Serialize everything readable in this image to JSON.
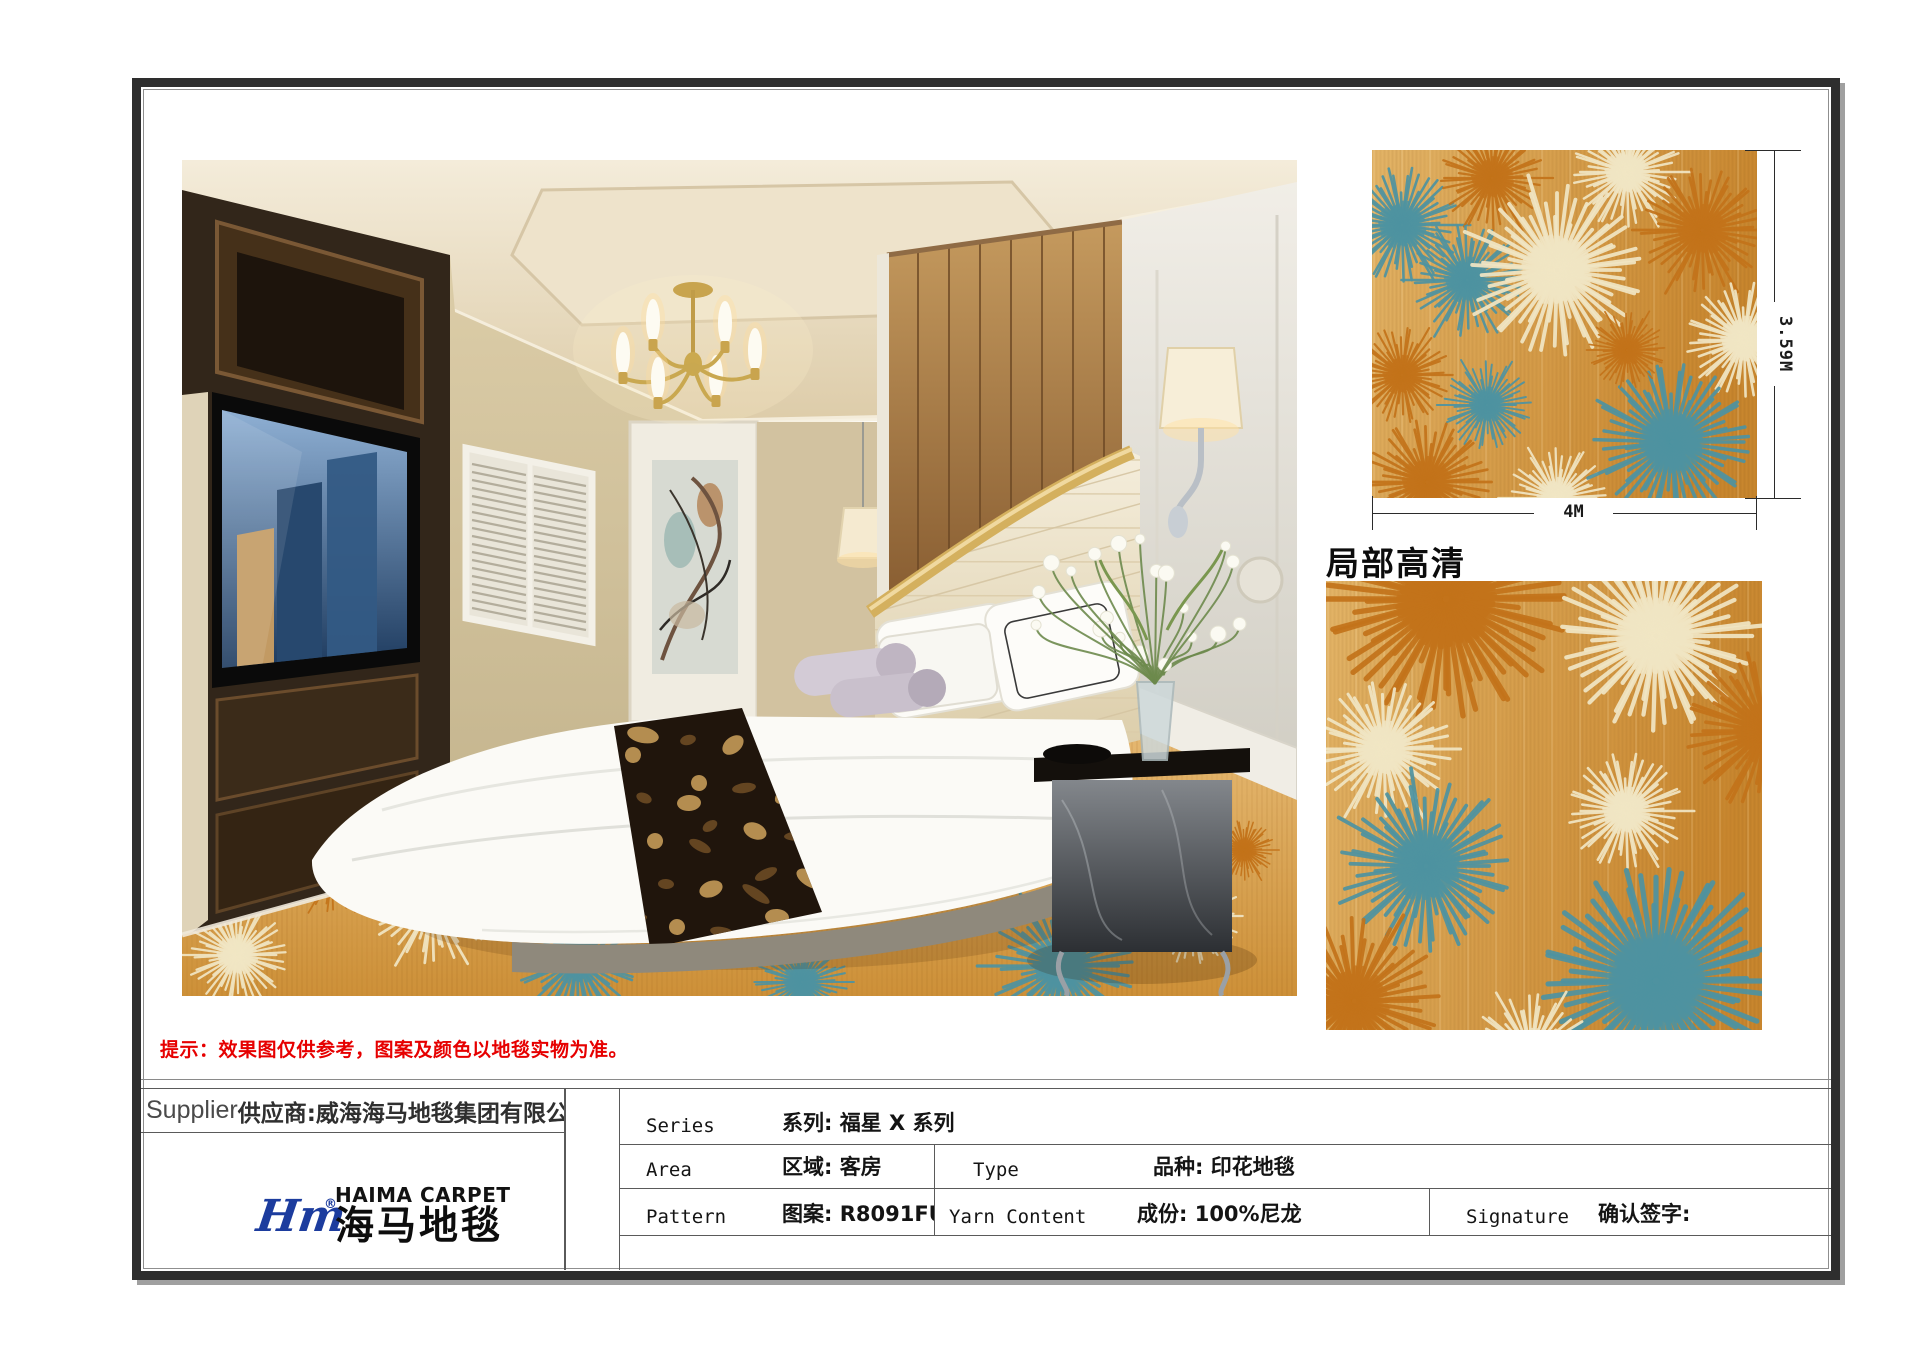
{
  "page": {
    "disclaimer": "提示：效果图仅供参考，图案及颜色以地毯实物为准。",
    "closeup_label": "局部高清"
  },
  "dimensions": {
    "width": "4M",
    "height": "3.59M"
  },
  "carpet_colors": {
    "base_light": "#E3B467",
    "base_dark": "#C8862E",
    "cream": "#F1E6C4",
    "orange": "#C3731A",
    "teal": "#4E93A1"
  },
  "logo": {
    "script": "Hm",
    "en": "HAIMA CARPET",
    "cn": "海马地毯",
    "registered": "®",
    "blue": "#1C3C9E"
  },
  "titleblock": {
    "supplier": {
      "en": "Supplier",
      "cn": "供应商:威海海马地毯集团有限公司"
    },
    "series": {
      "en": "Series",
      "cn": "系列: 福星 X 系列"
    },
    "area": {
      "en": "Area",
      "cn": "区域: 客房"
    },
    "type": {
      "en": "Type",
      "cn": "品种: 印花地毯"
    },
    "pattern": {
      "en": "Pattern",
      "cn": "图案: R8091FU/H211B"
    },
    "yarn": {
      "en": "Yarn Content",
      "cn": "成份: 100%尼龙"
    },
    "signature": {
      "en": "Signature",
      "cn": "确认签字:"
    }
  }
}
